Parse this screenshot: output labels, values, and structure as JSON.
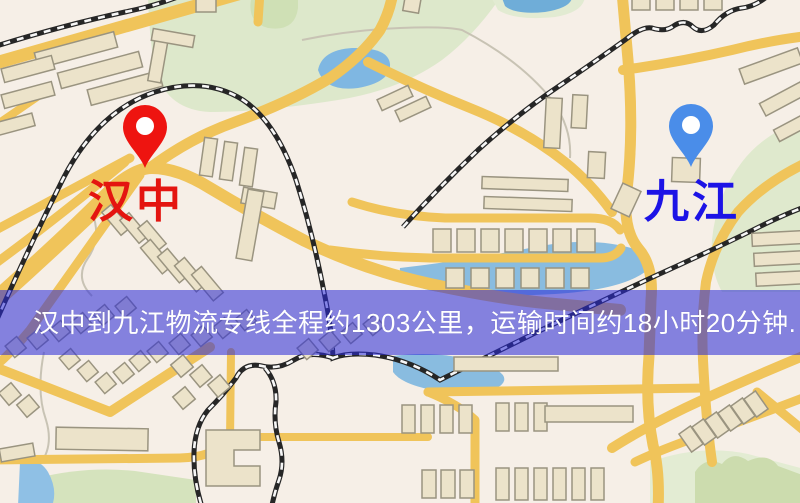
{
  "map": {
    "banner": {
      "text": "汉中到九江物流专线全程约1303公里，运输时间约18小时20分钟.",
      "bg_color": "rgba(42,42,216,0.56)",
      "text_color": "#ffffff"
    },
    "markers": [
      {
        "id": "origin",
        "label": "汉中",
        "label_color": "#e41510",
        "pin_color": "#ee1410",
        "pin_hole_color": "#ffffff"
      },
      {
        "id": "destination",
        "label": "九江",
        "label_color": "#1c13e6",
        "pin_color": "#4a8de9",
        "pin_hole_color": "#ffffff"
      }
    ],
    "legend_colors": {
      "background": "#f6efe7",
      "road": "#f0c45a",
      "park_green": "#dde8cb",
      "water_blue": "#7fb7e2",
      "building": "#ece3ca",
      "building_outline": "#9a9480",
      "railway": "#262626"
    }
  }
}
